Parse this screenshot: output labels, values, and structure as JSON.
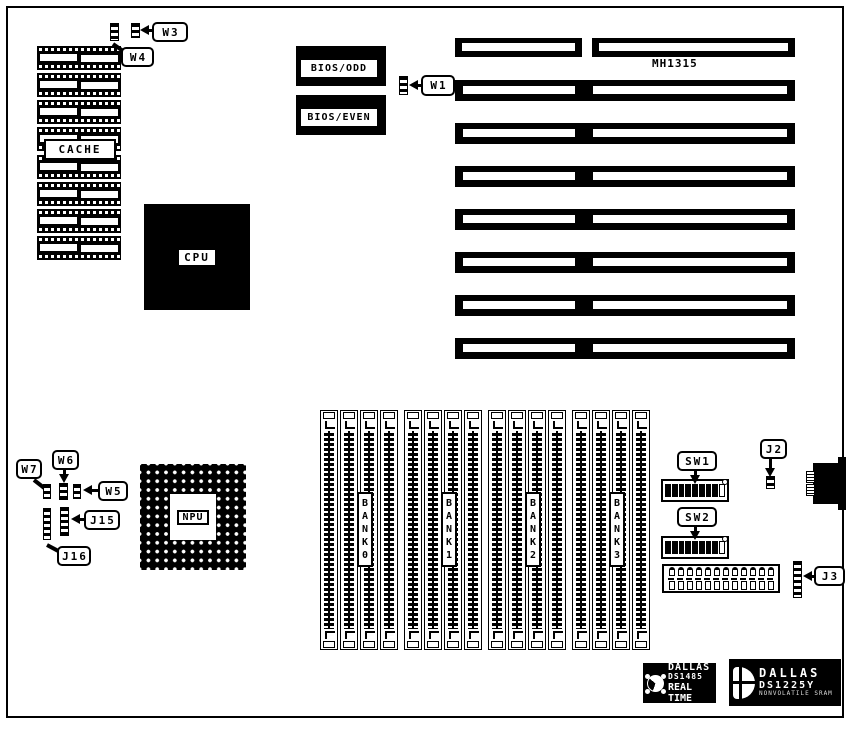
{
  "board": {
    "model": "MH1315",
    "chips": {
      "cache_label": "CACHE",
      "cpu_label": "CPU",
      "npu_label": "NPU",
      "bios_odd_label": "BIOS/ODD",
      "bios_even_label": "BIOS/EVEN"
    },
    "jumpers": {
      "w1": "W1",
      "w3": "W3",
      "w4": "W4",
      "w5": "W5",
      "w6": "W6",
      "w7": "W7",
      "j2": "J2",
      "j3": "J3",
      "j15": "J15",
      "j16": "J16"
    },
    "switches": {
      "sw1": "SW1",
      "sw2": "SW2"
    },
    "memory_banks": [
      "BANK 0",
      "BANK 1",
      "BANK 2",
      "BANK 3"
    ],
    "counts": {
      "cache_chip_rows": 8,
      "cache_chips_per_row": 2,
      "expansion_slot_rows": 8,
      "simm_banks": 4,
      "simm_slots_per_bank": 4,
      "dip_switch_on_positions": 8,
      "power_connector_pins": 12
    },
    "logos": {
      "rtc": {
        "brand": "DALLAS",
        "part": "DS1485",
        "tagline": "REAL TIME"
      },
      "nvram": {
        "brand": "DALLAS",
        "part": "DS1225Y",
        "tagline": "NONVOLATILE SRAM"
      }
    },
    "colors": {
      "ink": "#000000",
      "paper": "#ffffff"
    }
  }
}
